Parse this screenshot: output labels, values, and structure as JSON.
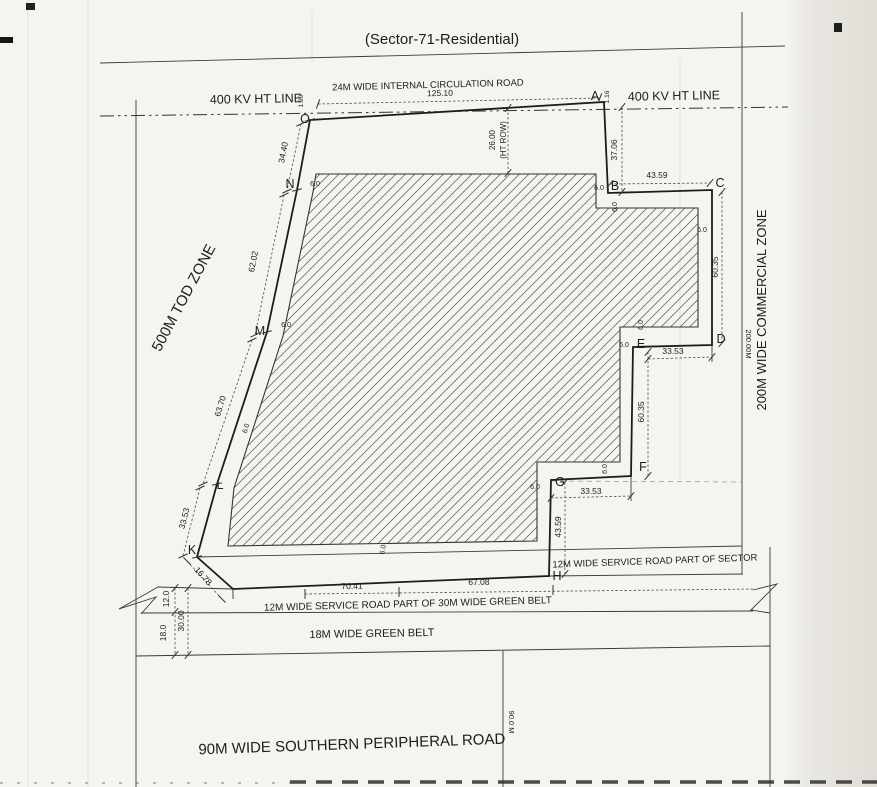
{
  "drawing": {
    "title": "(Sector-71-Residential)",
    "paper_color": "#f6f4ef",
    "ink_color": "#1d1d1d",
    "offset_label": "6.0",
    "texts": [
      {
        "id": "title",
        "t": "(Sector-71-Residential)",
        "x": 442,
        "y": 44,
        "r": 0,
        "s": 15
      },
      {
        "id": "circulation-road-label",
        "t": "24M WIDE INTERNAL CIRCULATION ROAD",
        "x": 428,
        "y": 88,
        "r": -1.5,
        "s": 9.5
      },
      {
        "id": "dim-125-10",
        "t": "125.10",
        "x": 440,
        "y": 96,
        "r": -1,
        "s": 8.5
      },
      {
        "id": "ht-line-left-label",
        "t": "400 KV HT LINE",
        "x": 256,
        "y": 103,
        "r": -1,
        "s": 12.5
      },
      {
        "id": "ht-line-right-label",
        "t": "400 KV HT LINE",
        "x": 674,
        "y": 100,
        "r": -1,
        "s": 12.5
      },
      {
        "id": "tod-zone-label",
        "t": "500M TOD ZONE",
        "x": 188,
        "y": 300,
        "r": -62,
        "s": 15
      },
      {
        "id": "commercial-zone-label",
        "t": "200M WIDE COMMERCIAL ZONE",
        "x": 766,
        "y": 310,
        "r": -90,
        "s": 13
      },
      {
        "id": "dim-200-00m",
        "t": "200.00M",
        "x": 746,
        "y": 344,
        "r": 90,
        "s": 7.5
      },
      {
        "id": "dim-26-00",
        "t": "26.00",
        "x": 495,
        "y": 140,
        "r": -90,
        "s": 8
      },
      {
        "id": "dim-ht-row",
        "t": "(HT ROW)",
        "x": 506,
        "y": 140,
        "r": -90,
        "s": 8
      },
      {
        "id": "dim-1-99",
        "t": "1.99",
        "x": 303,
        "y": 101,
        "r": -90,
        "s": 6.5
      },
      {
        "id": "dim-1-16",
        "t": "1.16",
        "x": 609,
        "y": 97,
        "r": -90,
        "s": 6.5
      },
      {
        "id": "dim-37-06",
        "t": "37.06",
        "x": 617,
        "y": 150,
        "r": -90,
        "s": 8.5
      },
      {
        "id": "dim-43-59-bc",
        "t": "43.59",
        "x": 657,
        "y": 178,
        "r": 0,
        "s": 8.5
      },
      {
        "id": "dim-60-35-cd",
        "t": "60.35",
        "x": 718,
        "y": 267,
        "r": -90,
        "s": 8.5
      },
      {
        "id": "dim-33-53-ed",
        "t": "33.53",
        "x": 673,
        "y": 354,
        "r": 0,
        "s": 8.5
      },
      {
        "id": "dim-60-35-ef",
        "t": "60.35",
        "x": 644,
        "y": 412,
        "r": -90,
        "s": 8.5
      },
      {
        "id": "dim-33-53-gf",
        "t": "33.53",
        "x": 591,
        "y": 494,
        "r": 0,
        "s": 8.5
      },
      {
        "id": "dim-43-59-gh",
        "t": "43.59",
        "x": 561,
        "y": 527,
        "r": -90,
        "s": 8.5
      },
      {
        "id": "dim-34-40",
        "t": "34.40",
        "x": 286,
        "y": 153,
        "r": -79,
        "s": 8.5
      },
      {
        "id": "dim-62-02",
        "t": "62.02",
        "x": 256,
        "y": 262,
        "r": -79,
        "s": 8.5
      },
      {
        "id": "dim-63-70",
        "t": "63.70",
        "x": 223,
        "y": 407,
        "r": -73,
        "s": 8.5
      },
      {
        "id": "dim-33-53-lk",
        "t": "33.53",
        "x": 187,
        "y": 519,
        "r": -76,
        "s": 8.5
      },
      {
        "id": "dim-16-78",
        "t": "16.78",
        "x": 201,
        "y": 578,
        "r": 48,
        "s": 8.5
      },
      {
        "id": "dim-70-41",
        "t": "70.41",
        "x": 352,
        "y": 589,
        "r": -1,
        "s": 8.5
      },
      {
        "id": "dim-67-08",
        "t": "67.08",
        "x": 479,
        "y": 585,
        "r": -1,
        "s": 8.5
      },
      {
        "id": "dim-12-0",
        "t": "12.0",
        "x": 169,
        "y": 599,
        "r": -90,
        "s": 8.5
      },
      {
        "id": "dim-30-00",
        "t": "30.00",
        "x": 184,
        "y": 621,
        "r": -90,
        "s": 8.5
      },
      {
        "id": "dim-18-0",
        "t": "18.0",
        "x": 166,
        "y": 633,
        "r": -90,
        "s": 8.5
      },
      {
        "id": "service-road-sector-label",
        "t": "12M WIDE SERVICE ROAD PART OF SECTOR",
        "x": 655,
        "y": 564,
        "r": -2,
        "s": 9.5
      },
      {
        "id": "service-road-greenbelt-label",
        "t": "12M WIDE SERVICE ROAD PART OF 30M WIDE GREEN BELT",
        "x": 408,
        "y": 607,
        "r": -1.5,
        "s": 10
      },
      {
        "id": "green-belt-label",
        "t": "18M WIDE GREEN BELT",
        "x": 372,
        "y": 637,
        "r": -1,
        "s": 11
      },
      {
        "id": "southern-road-label",
        "t": "90M WIDE SOUTHERN PERIPHERAL ROAD",
        "x": 352,
        "y": 749,
        "r": -2,
        "s": 15
      },
      {
        "id": "dim-90-0m",
        "t": "90.0 M",
        "x": 509,
        "y": 722,
        "r": 90,
        "s": 7.5
      }
    ],
    "vertex_labels": [
      {
        "id": "A",
        "x": 595,
        "y": 100
      },
      {
        "id": "B",
        "x": 615,
        "y": 190
      },
      {
        "id": "C",
        "x": 720,
        "y": 187
      },
      {
        "id": "D",
        "x": 721,
        "y": 343
      },
      {
        "id": "E",
        "x": 641,
        "y": 348
      },
      {
        "id": "F",
        "x": 643,
        "y": 471
      },
      {
        "id": "G",
        "x": 560,
        "y": 486
      },
      {
        "id": "H",
        "x": 557,
        "y": 580
      },
      {
        "id": "K",
        "x": 192,
        "y": 554
      },
      {
        "id": "L",
        "x": 220,
        "y": 489
      },
      {
        "id": "M",
        "x": 260,
        "y": 335
      },
      {
        "id": "N",
        "x": 290,
        "y": 188
      },
      {
        "id": "O",
        "x": 305,
        "y": 123
      }
    ],
    "offset_positions": [
      {
        "x": 315,
        "y": 186,
        "r": 0
      },
      {
        "x": 286,
        "y": 327,
        "r": 0
      },
      {
        "x": 248,
        "y": 429,
        "r": -73
      },
      {
        "x": 599,
        "y": 190,
        "r": 0
      },
      {
        "x": 617,
        "y": 207,
        "r": -90
      },
      {
        "x": 702,
        "y": 232,
        "r": 0
      },
      {
        "x": 643,
        "y": 325,
        "r": -90
      },
      {
        "x": 624,
        "y": 347,
        "r": 0
      },
      {
        "x": 607,
        "y": 469,
        "r": -90
      },
      {
        "x": 535,
        "y": 489,
        "r": 0
      },
      {
        "x": 385,
        "y": 550,
        "r": -80
      }
    ]
  }
}
